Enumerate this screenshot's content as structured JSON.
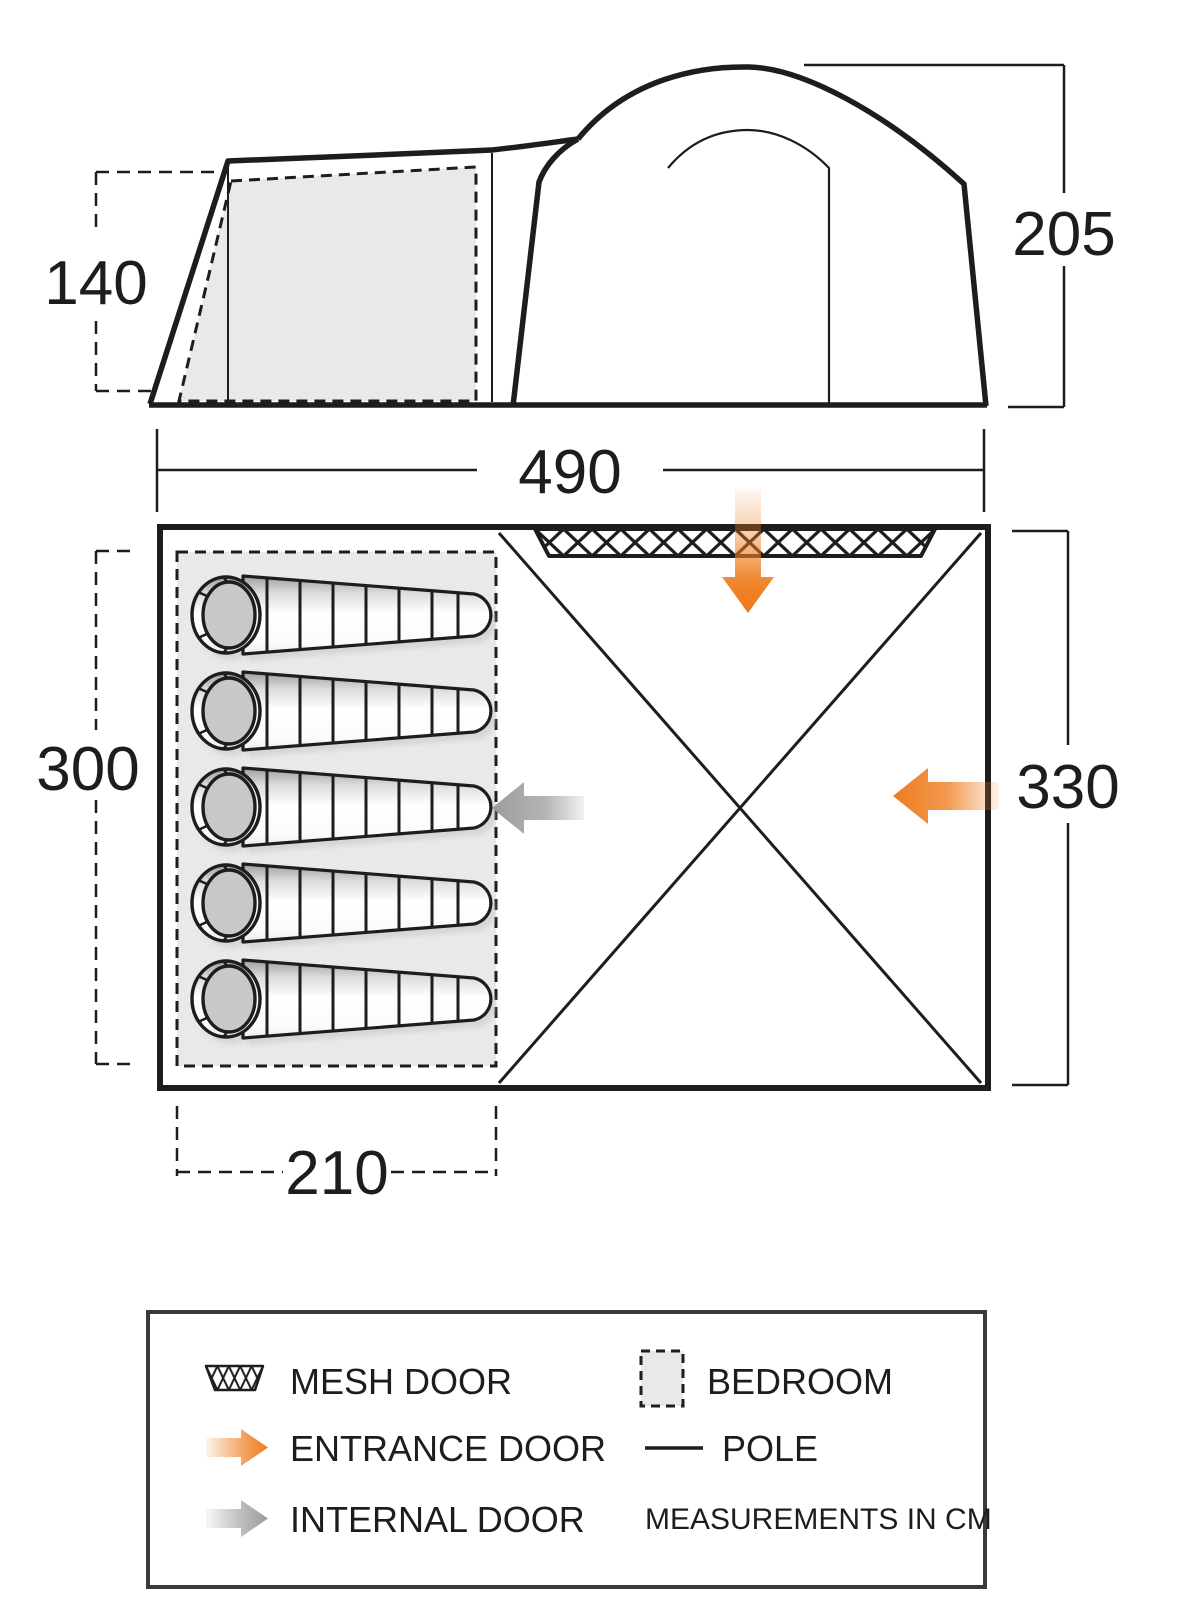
{
  "diagram_title": "tent-dimension-diagram",
  "dimensions": {
    "side_height_porch": "140",
    "side_height_main": "205",
    "side_length": "490",
    "bedroom_depth": "300",
    "tent_width": "330",
    "bedroom_length": "210"
  },
  "floor_plan": {
    "sleeping_bag_count": 5
  },
  "legend": {
    "items": [
      {
        "icon": "mesh-swatch-icon",
        "label": "MESH DOOR"
      },
      {
        "icon": "bedroom-swatch-icon",
        "label": "BEDROOM"
      },
      {
        "icon": "entrance-arrow-icon",
        "label": "ENTRANCE DOOR"
      },
      {
        "icon": "pole-line-icon",
        "label": "POLE"
      },
      {
        "icon": "internal-arrow-icon",
        "label": "INTERNAL DOOR"
      }
    ],
    "note": "MEASUREMENTS IN CM"
  },
  "colors": {
    "line": "#1d1d1b",
    "entrance_orange": "#ee7c1e",
    "internal_gray": "#9c9c9c",
    "bedroom_fill": "#eae8e8"
  }
}
